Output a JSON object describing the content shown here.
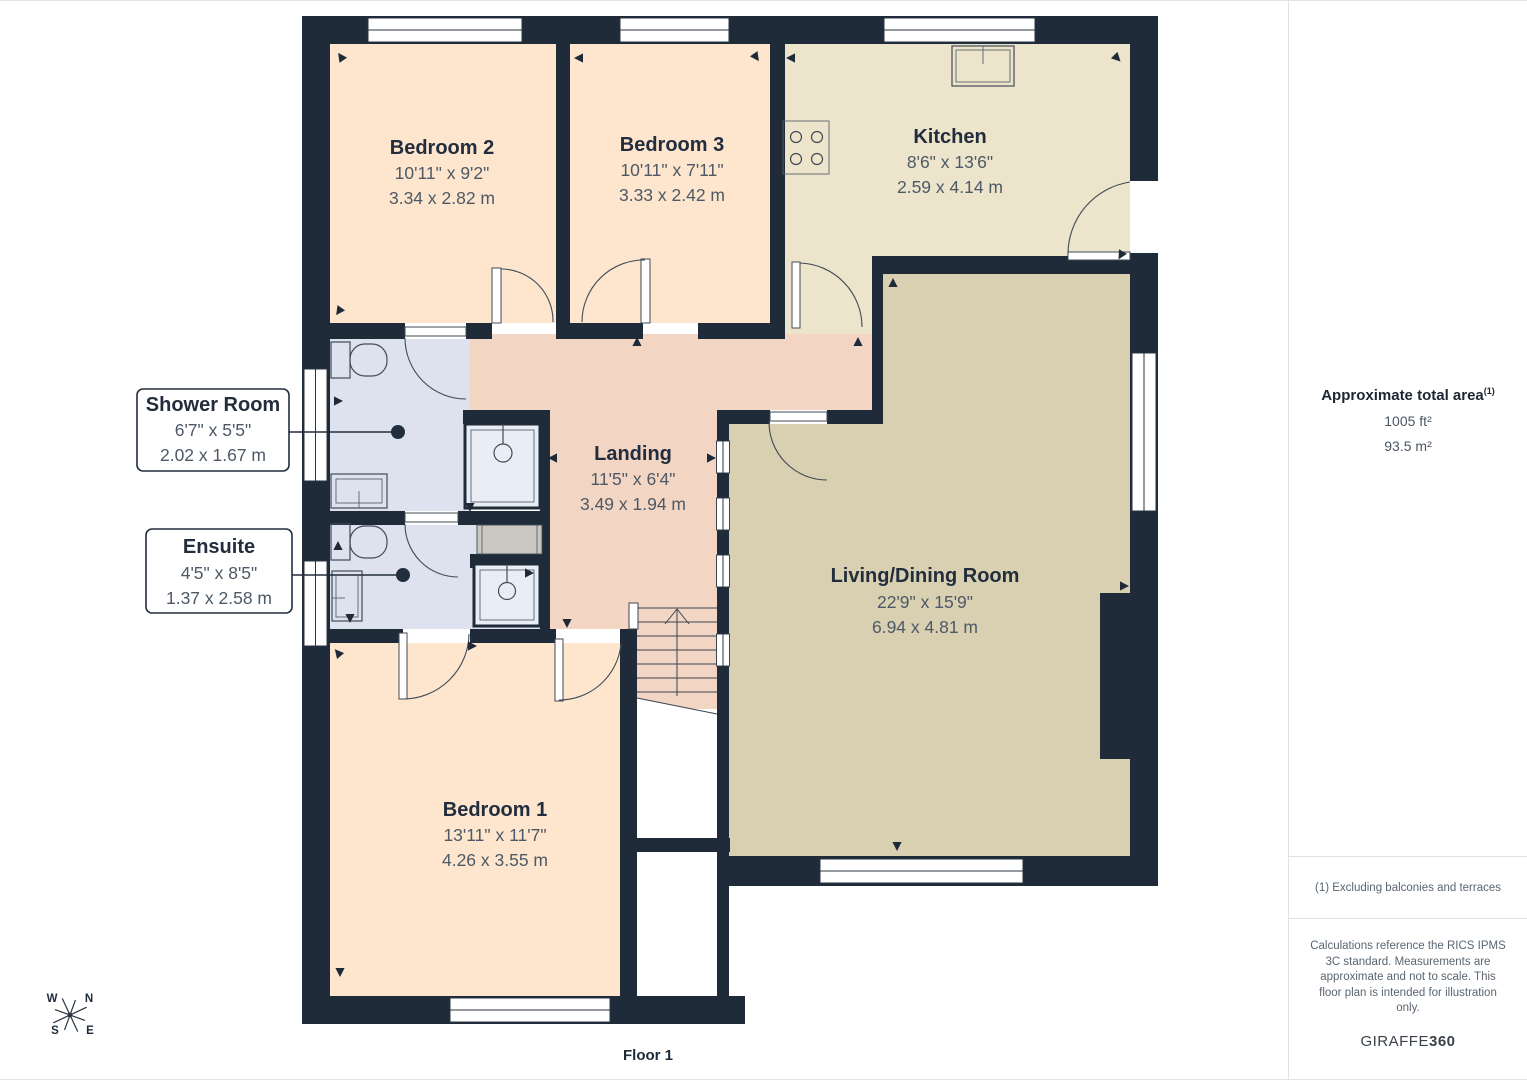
{
  "title": "Floor plan",
  "floor_label": "Floor 1",
  "rooms": [
    {
      "name": "Bedroom 2",
      "imperial": "10'11\" x 9'2\"",
      "metric": "3.34 x 2.82 m"
    },
    {
      "name": "Bedroom 3",
      "imperial": "10'11\" x 7'11\"",
      "metric": "3.33 x 2.42 m"
    },
    {
      "name": "Kitchen",
      "imperial": "8'6\" x 13'6\"",
      "metric": "2.59 x 4.14 m"
    },
    {
      "name": "Landing",
      "imperial": "11'5\" x 6'4\"",
      "metric": "3.49 x 1.94 m"
    },
    {
      "name": "Living/Dining Room",
      "imperial": "22'9\" x 15'9\"",
      "metric": "6.94 x 4.81 m"
    },
    {
      "name": "Shower Room",
      "imperial": "6'7\" x 5'5\"",
      "metric": "2.02 x 1.67 m"
    },
    {
      "name": "Ensuite",
      "imperial": "4'5\" x 8'5\"",
      "metric": "1.37 x 2.58 m"
    },
    {
      "name": "Bedroom 1",
      "imperial": "13'11\" x 11'7\"",
      "metric": "4.26 x 3.55 m"
    }
  ],
  "sidebar": {
    "area_title": "Approximate total area",
    "area_sup": "(1)",
    "area_ft": "1005 ft²",
    "area_m": "93.5 m²",
    "note": "(1) Excluding balconies and terraces",
    "disclaimer": "Calculations reference the RICS IPMS 3C standard. Measurements are approximate and not to scale. This floor plan is intended for illustration only.",
    "brand_regular": "GIRAFFE",
    "brand_bold": "360"
  },
  "compass": {
    "n": "N",
    "s": "S",
    "e": "E",
    "w": "W"
  },
  "colors": {
    "wall": "#202b3a",
    "bedroom_fill": "#fde6cd",
    "kitchen_fill": "#ece4cb",
    "living_fill": "#d9cfb1",
    "landing_fill": "#f3d5c3",
    "bathroom_fill": "#dde2ee",
    "cupboard_fill": "#cac6c0"
  }
}
